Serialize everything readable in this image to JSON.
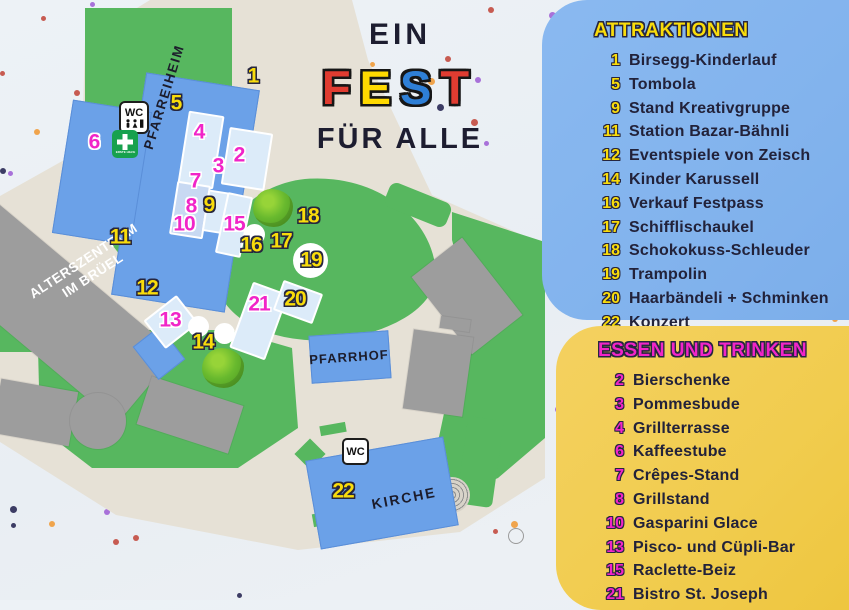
{
  "theme": {
    "green": "#57b75f",
    "blue": "#6ba1e8",
    "beige": "#e6e1d6",
    "gray": "#9d9d9d",
    "navy": "#26263f",
    "attraction_number": "#f9dc0b",
    "food_number": "#f125c8",
    "panel_attractions_bg": "#82b4ee",
    "panel_food_bg": "#f2cd52",
    "confetti": [
      "#a871d9",
      "#c75b51",
      "#f0a44c",
      "#3c3c64"
    ]
  },
  "title": {
    "line1": "EIN",
    "fest": [
      {
        "ch": "F",
        "color": "#e03c31"
      },
      {
        "ch": "E",
        "color": "#ffd900"
      },
      {
        "ch": "S",
        "color": "#2e7fd6"
      },
      {
        "ch": "T",
        "color": "#e03c31"
      }
    ],
    "line3": "FÜR ALLE"
  },
  "panels": {
    "attractions": {
      "heading": "ATTRAKTIONEN",
      "items": [
        {
          "num": "1",
          "label": "Birsegg-Kinderlauf"
        },
        {
          "num": "5",
          "label": "Tombola"
        },
        {
          "num": "9",
          "label": "Stand Kreativgruppe"
        },
        {
          "num": "11",
          "label": "Station Bazar-Bähnli"
        },
        {
          "num": "12",
          "label": "Eventspiele von Zeisch"
        },
        {
          "num": "14",
          "label": "Kinder Karussell"
        },
        {
          "num": "16",
          "label": "Verkauf Festpass"
        },
        {
          "num": "17",
          "label": "Schifflischaukel"
        },
        {
          "num": "18",
          "label": "Schokokuss-Schleuder"
        },
        {
          "num": "19",
          "label": "Trampolin"
        },
        {
          "num": "20",
          "label": "Haarbändeli + Schminken"
        },
        {
          "num": "22",
          "label": "Konzert"
        }
      ]
    },
    "food": {
      "heading": "ESSEN UND TRINKEN",
      "items": [
        {
          "num": "2",
          "label": "Bierschenke"
        },
        {
          "num": "3",
          "label": "Pommesbude"
        },
        {
          "num": "4",
          "label": "Grillterrasse"
        },
        {
          "num": "6",
          "label": "Kaffeestube"
        },
        {
          "num": "7",
          "label": "Crêpes-Stand"
        },
        {
          "num": "8",
          "label": "Grillstand"
        },
        {
          "num": "10",
          "label": "Gasparini Glace"
        },
        {
          "num": "13",
          "label": "Pisco- und Cüpli-Bar"
        },
        {
          "num": "15",
          "label": "Raclette-Beiz"
        },
        {
          "num": "21",
          "label": "Bistro St. Joseph"
        }
      ]
    }
  },
  "map": {
    "labels": {
      "pfarreiheim": "PFARREIHEIM",
      "alterszentrum_line1": "ALTERSZENTRUM",
      "alterszentrum_line2": "IM BRÜEL",
      "pfarrhof": "PFARRHOF",
      "kirche": "KIRCHE"
    },
    "signs": {
      "wc": "WC",
      "first_aid": "ERSTE HILFE"
    },
    "markers": [
      {
        "num": "1",
        "x": 253,
        "y": 76,
        "type": "attraction"
      },
      {
        "num": "5",
        "x": 176,
        "y": 103,
        "type": "attraction"
      },
      {
        "num": "6",
        "x": 94,
        "y": 142,
        "type": "food"
      },
      {
        "num": "4",
        "x": 199,
        "y": 132,
        "type": "food"
      },
      {
        "num": "2",
        "x": 239,
        "y": 155,
        "type": "food"
      },
      {
        "num": "3",
        "x": 218,
        "y": 166,
        "type": "food"
      },
      {
        "num": "7",
        "x": 195,
        "y": 181,
        "type": "food"
      },
      {
        "num": "8",
        "x": 191,
        "y": 206,
        "type": "food"
      },
      {
        "num": "9",
        "x": 209,
        "y": 205,
        "type": "attraction"
      },
      {
        "num": "10",
        "x": 184,
        "y": 224,
        "type": "food"
      },
      {
        "num": "11",
        "x": 120,
        "y": 237,
        "type": "attraction"
      },
      {
        "num": "15",
        "x": 234,
        "y": 224,
        "type": "food"
      },
      {
        "num": "16",
        "x": 251,
        "y": 245,
        "type": "attraction"
      },
      {
        "num": "17",
        "x": 281,
        "y": 241,
        "type": "attraction"
      },
      {
        "num": "18",
        "x": 308,
        "y": 216,
        "type": "attraction"
      },
      {
        "num": "19",
        "x": 311,
        "y": 260,
        "type": "attraction"
      },
      {
        "num": "12",
        "x": 147,
        "y": 288,
        "type": "attraction"
      },
      {
        "num": "13",
        "x": 170,
        "y": 320,
        "type": "food"
      },
      {
        "num": "14",
        "x": 203,
        "y": 342,
        "type": "attraction"
      },
      {
        "num": "21",
        "x": 259,
        "y": 304,
        "type": "food"
      },
      {
        "num": "20",
        "x": 295,
        "y": 299,
        "type": "attraction"
      },
      {
        "num": "22",
        "x": 343,
        "y": 491,
        "type": "attraction"
      }
    ]
  }
}
